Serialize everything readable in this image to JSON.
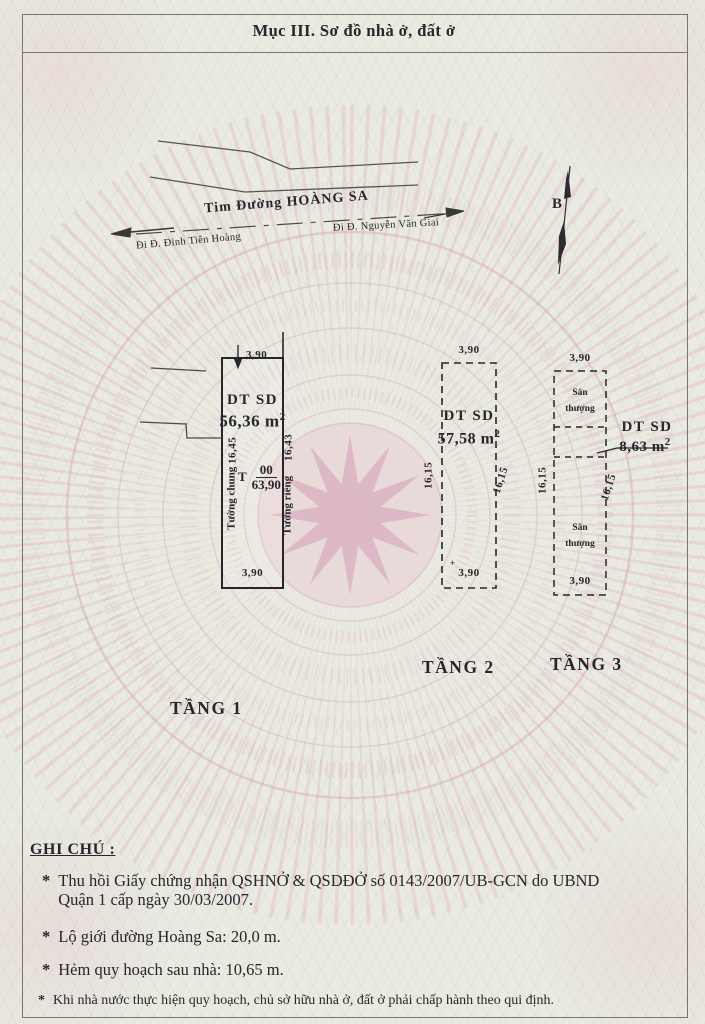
{
  "colors": {
    "paper": "#e9ebe1",
    "watermark_pink": "#dfb3c3",
    "ink": "#26262c",
    "line": "#4a4a48"
  },
  "header": {
    "title": "Mục III. Sơ đồ nhà ở, đất ở"
  },
  "road": {
    "centerline_label": "Tim Đường HOÀNG SA",
    "direction_left": "Đi Đ. Đinh Tiên Hoàng",
    "direction_right": "Đi Đ. Nguyễn Văn Giai"
  },
  "compass": {
    "north_label": "B"
  },
  "floors": [
    {
      "name": "TẦNG 1",
      "area_label": "DT SD",
      "area_value": "56,36 m",
      "area_sup": "2",
      "dim_top": "3,90",
      "dim_bottom": "3,90",
      "wall_left": "Tường chung",
      "dim_left": "16,45",
      "wall_right": "Tường riêng",
      "dim_right": "16,43",
      "marker_prefix": "T",
      "marker_numerator": "00",
      "marker_denominator": "63,90"
    },
    {
      "name": "TẦNG 2",
      "area_label": "DT SD",
      "area_value": "57,58 m",
      "area_sup": "2",
      "dim_top": "3,90",
      "dim_bottom": "3,90",
      "dim_left": "16,15",
      "dim_right": "16,15",
      "corner_mark": "+"
    },
    {
      "name": "TẦNG 3",
      "area_label": "DT SD",
      "area_value": "8,63 m",
      "area_sup": "2",
      "dim_top": "3,90",
      "dim_bottom": "3,90",
      "dim_left": "16,15",
      "dim_right": "16,15",
      "terrace_top": "Sân thượng",
      "terrace_bottom": "Sân thượng"
    }
  ],
  "notes": {
    "heading": "GHI CHÚ :",
    "bullet": "*",
    "items": [
      {
        "text": "Thu hồi Giấy chứng nhận QSHNỞ & QSDĐỞ số 0143/2007/UB-GCN do UBND",
        "text2": "Quận 1 cấp ngày 30/03/2007."
      },
      {
        "text": "Lộ giới đường Hoàng Sa: 20,0 m."
      },
      {
        "text": "Hẻm quy hoạch sau nhà: 10,65 m."
      },
      {
        "text": "Khi nhà nước thực hiện quy hoạch, chủ sở hữu nhà ở, đất ở phải chấp hành theo qui định."
      }
    ]
  }
}
